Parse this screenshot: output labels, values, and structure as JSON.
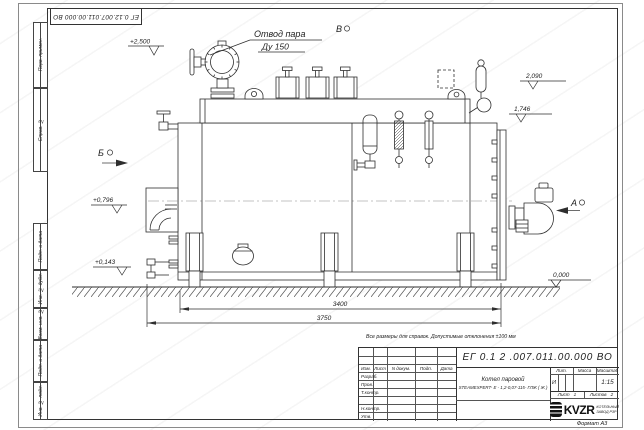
{
  "document": {
    "format_label": "Формат А3",
    "note": "Все размеры для справок. Допустимые отклонения ±100 мм"
  },
  "frame": {
    "top_doc_number": "ЕГ 0.12.007.011.00.000  ВО",
    "left_labels": [
      "Перв. примен.",
      "Справ. №",
      "Подп. и дата",
      "Инв. № дубл.",
      "Взам. инв. №",
      "Подп. и дата",
      "Инв. № подл."
    ]
  },
  "drawing": {
    "callout_line1": "Отвод пара",
    "callout_line2": "Ду 150",
    "section_a": "А",
    "section_b": "Б",
    "section_v": "В",
    "elev_2500": "+2,500",
    "elev_2090": "2,090",
    "elev_1746": "1,746",
    "elev_0796": "+0,796",
    "elev_0143": "+0,143",
    "elev_0000": "0,000",
    "dim_3400": "3400",
    "dim_3750": "3750"
  },
  "title_block": {
    "doc_number": "ЕГ 0.1 2 .007.011.00.000  ВО",
    "product_line1": "Котел паровой",
    "product_line2": "STEAMEXPERT- Е - 1,2-0,07-115- ГЛЖ ( Ж )",
    "col_izm": "Изм.",
    "col_list": "Лист",
    "col_ndoc": "N докум.",
    "col_podp": "Подп.",
    "col_data": "Дата",
    "row_razrab": "Разраб.",
    "row_prov": "Пров.",
    "row_tkontr": "Т.контр.",
    "row_nkontr": "Н.контр.",
    "row_utv": "Утв.",
    "lit_label": "Лит.",
    "lit_value": "И",
    "mass_label": "Масса",
    "scale_label": "Масштаб",
    "scale_value": "1:15",
    "sheet_label": "Лист",
    "sheet_value": "1",
    "sheets_label": "Листов",
    "sheets_value": "2",
    "logo": "KVZR",
    "company_line1": "КОТЕЛЬНЫЙ",
    "company_line2": "ЗАВОД РЗР"
  }
}
